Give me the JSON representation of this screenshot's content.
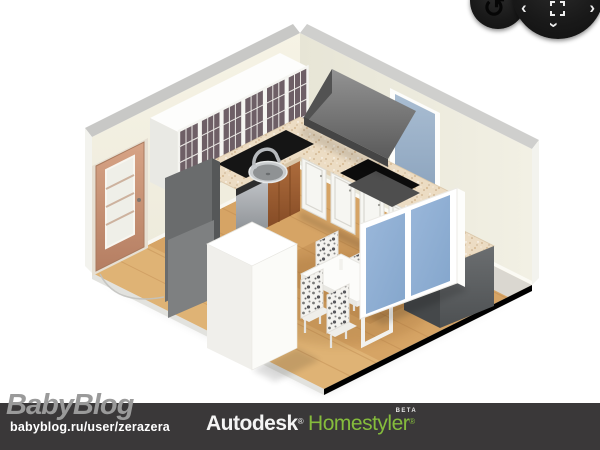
{
  "watermark": {
    "logo": "BabyBlog",
    "url": "babyblog.ru/user/zerazera"
  },
  "footer": {
    "brand_primary": "Autodesk",
    "brand_primary_reg": "®",
    "brand_secondary": "Homestyler",
    "brand_secondary_reg": "®",
    "beta_label": "BETA"
  },
  "controls": {
    "rotate_icon": "↺",
    "pan_left": "‹",
    "pan_right": "›",
    "pan_down": "›"
  },
  "colors": {
    "page_bg": "#ffffff",
    "footer_bg": "#3a3839",
    "autodesk_white": "#f4f4f4",
    "homestyler_green": "#85bc3c",
    "watermark_gray": "#9a9a9a",
    "wall_cream": "#f3f0e2",
    "wall_cream_dark": "#eae8da",
    "wall_cap_gray": "#c8c8c6",
    "floor_wood": "#d6a465",
    "granite_beige": "#ecdcc3",
    "cabinet_white": "#f6f6f2",
    "door_tan": "#c9937b",
    "appliance_gray": "#a8abaf",
    "hood_gray": "#6f6f6f",
    "blue_door": "#8fb0d4",
    "dark_cabinet": "#5d6062",
    "wood_cabinet_brown": "#9c5f33",
    "black_counter": "#151515"
  },
  "scene": {
    "view": "isometric-3d-kitchen",
    "objects": [
      "wood-floor",
      "room-walls",
      "interior-door",
      "glass-front-wall-cabinets",
      "black-corner-counter",
      "dishwasher",
      "kitchen-sink",
      "faucet",
      "granite-countertop",
      "wood-base-cabinet",
      "white-base-cabinets",
      "cooktop",
      "range-hood",
      "window",
      "tall-gray-cabinet",
      "refrigerator",
      "dining-table",
      "dining-chairs",
      "blue-door-cabinet",
      "dark-base-cabinet"
    ]
  }
}
